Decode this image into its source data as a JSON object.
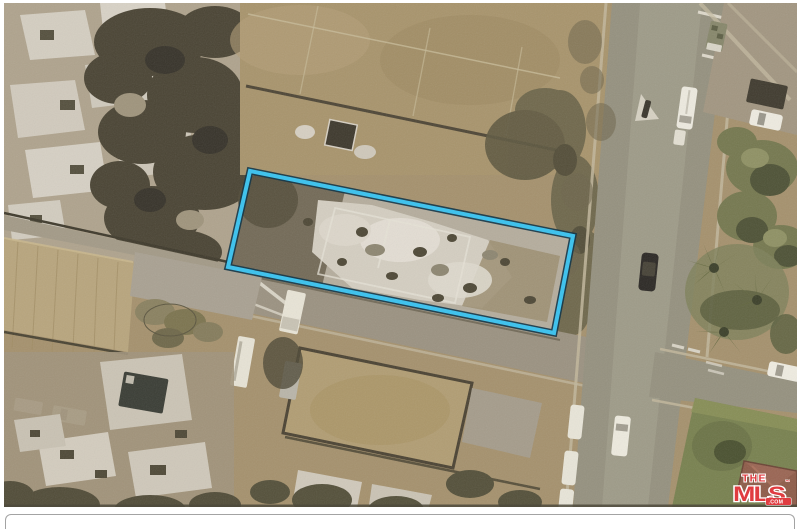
{
  "photo": {
    "subject": "aerial view of fire-damaged residential block with highlighted vacant parcel, street with cars at right",
    "palette": {
      "ground": "#a5916d",
      "road": "#95917f",
      "street_secondary": "#9b9281",
      "rubble_light": "#d4cec1",
      "trees_dark": "#4a4434",
      "lawn": "#78814f",
      "roof": "#8e5c49",
      "pool": "#3a3d35",
      "field": "#b8a57d",
      "sidewalk": "#c2b79c"
    }
  },
  "parcel_overlay": {
    "stroke_color": "#41c2ec",
    "edge_color": "#16384a"
  },
  "watermark": {
    "the": "THE",
    "mls": "MLS",
    "tm": "™",
    "com": ".COM",
    "brand_color": "#e03c40",
    "text_color": "#ffffff"
  },
  "bottom_panel": {
    "border_color": "#a3a3a3"
  }
}
